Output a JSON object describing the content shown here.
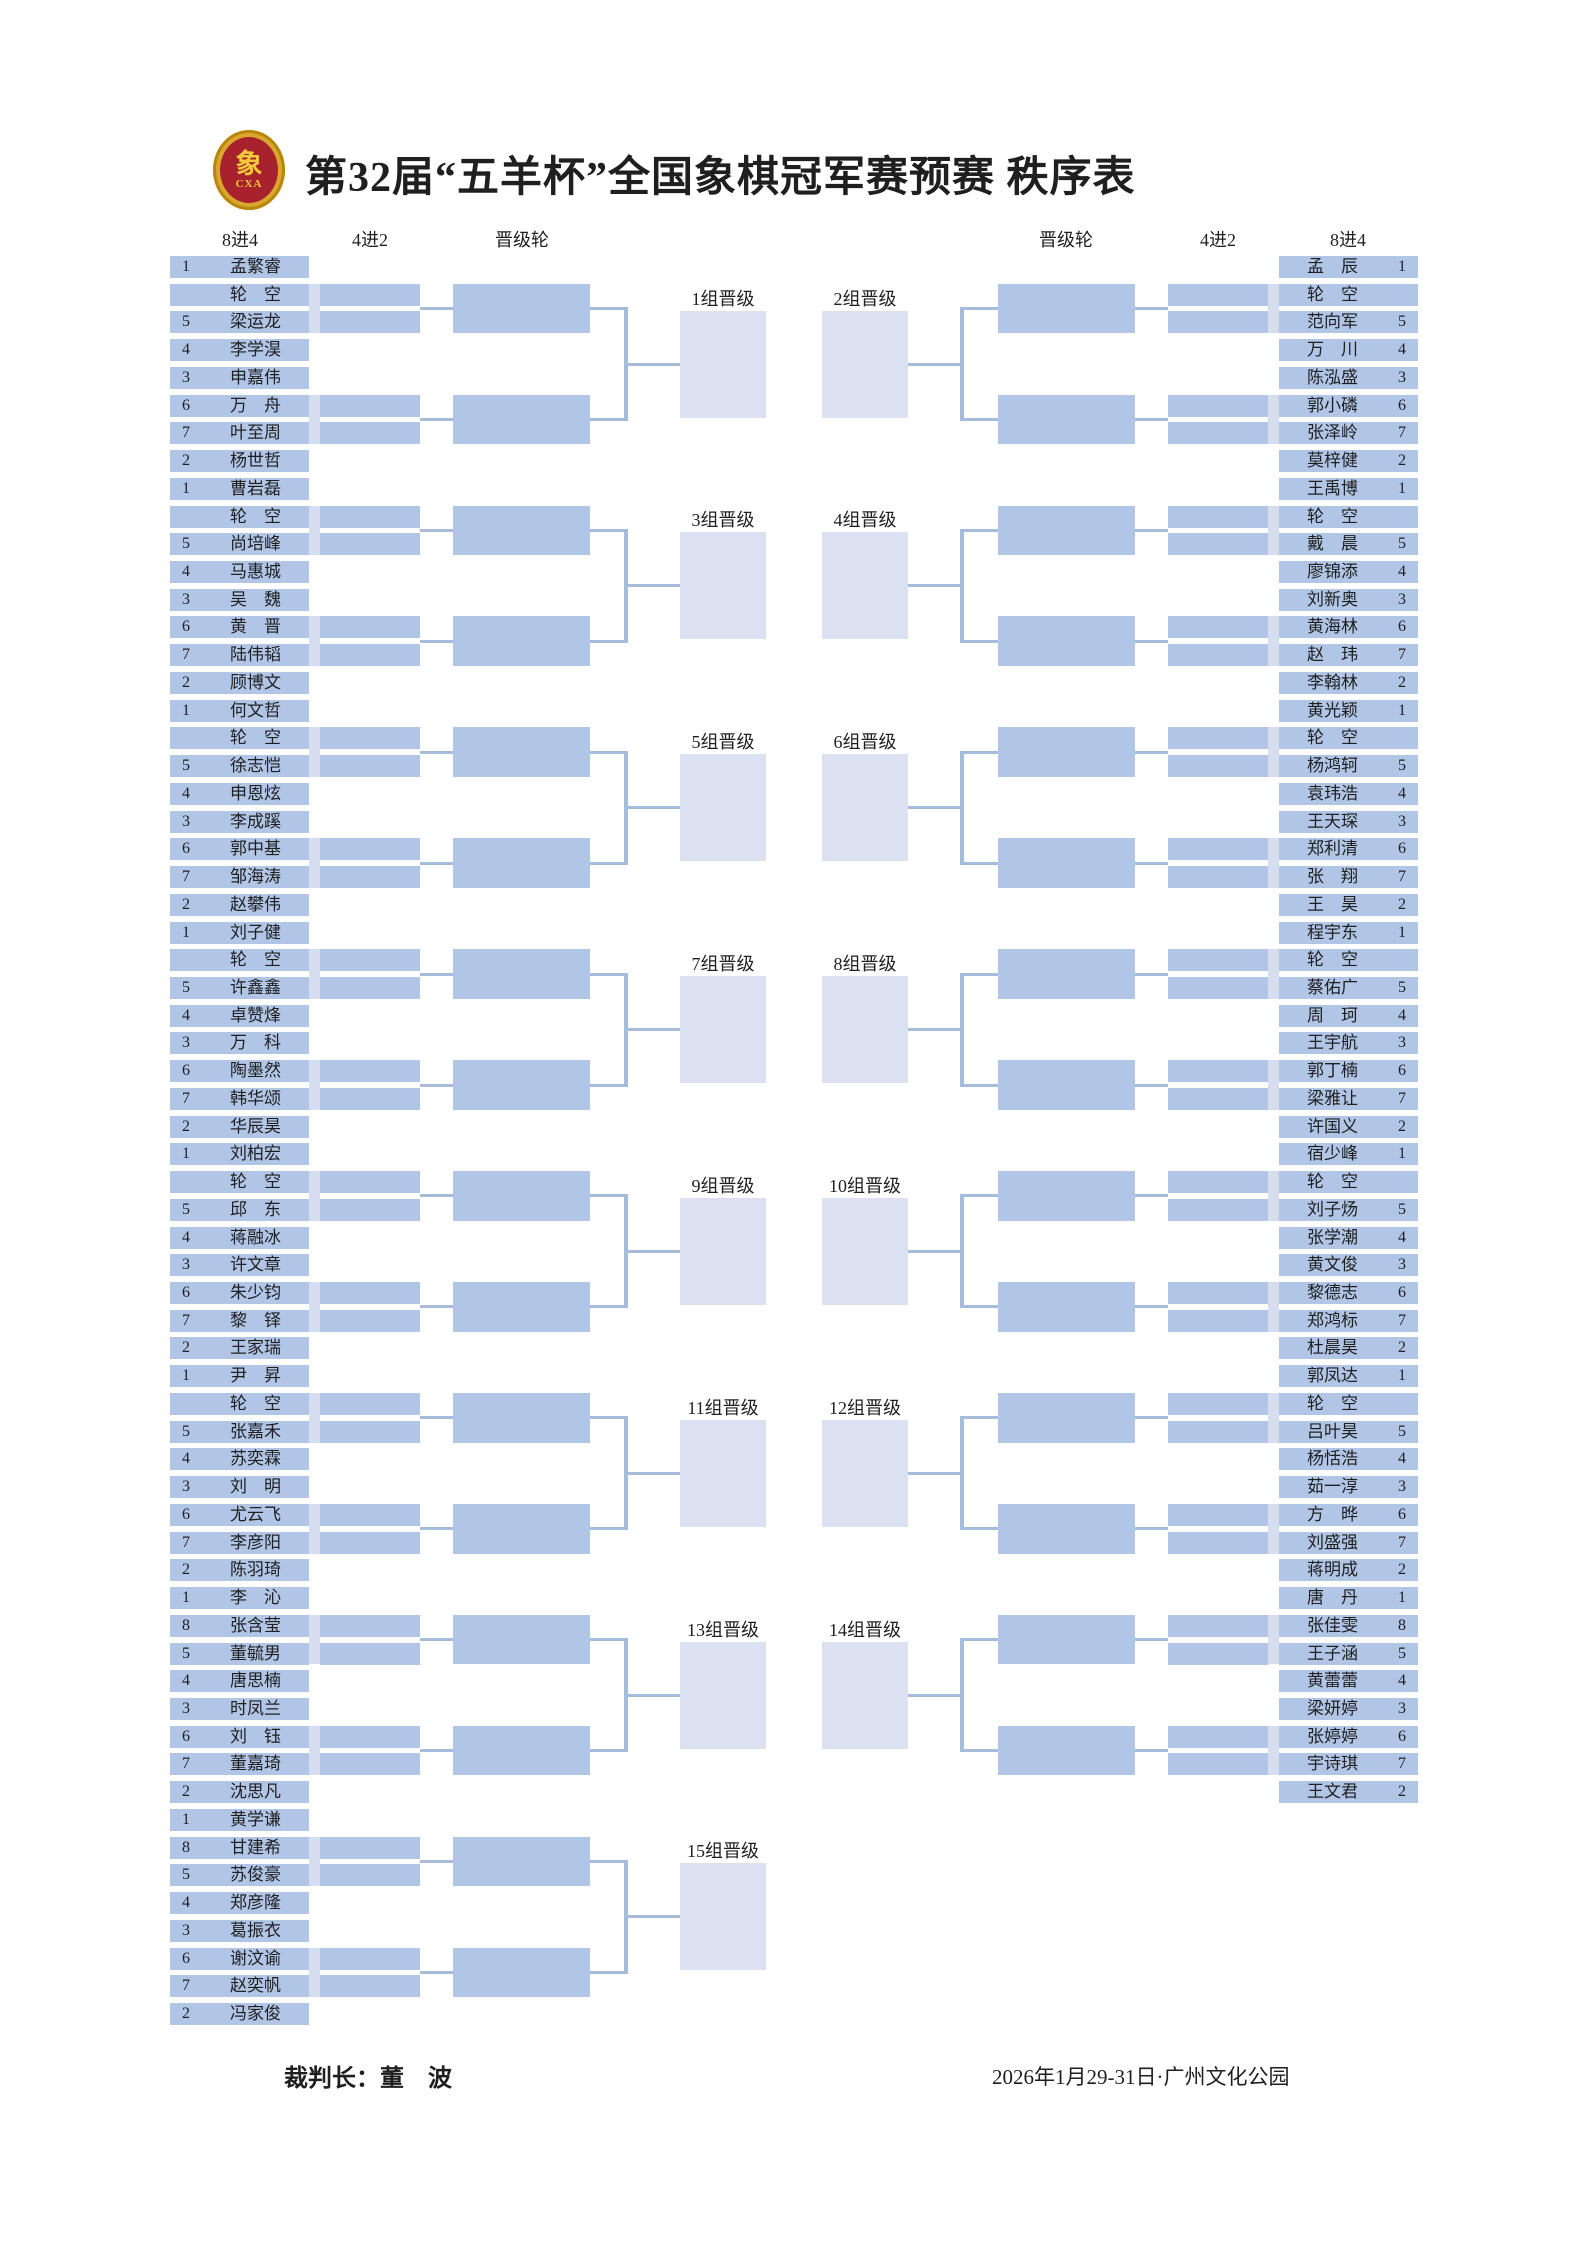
{
  "title": "第32届“五羊杯”全国象棋冠军赛预赛  秩序表",
  "logo": {
    "glyph": "象",
    "sub": "CXA"
  },
  "headers": {
    "left": [
      "8进4",
      "4进2",
      "晋级轮"
    ],
    "right": [
      "晋级轮",
      "4进2",
      "8进4"
    ]
  },
  "footer": {
    "referee": "裁判长：董　波",
    "event_info": "2026年1月29-31日·广州文化公园"
  },
  "colors": {
    "cell": "#b1c5e6",
    "stub": "#d5ddef",
    "box": "#dbe1f1",
    "line": "#a6bcdc",
    "text": "#1f1f1f",
    "logo_gold": "#d9a62e",
    "logo_red": "#a7222c"
  },
  "left_groups": [
    {
      "label": "1组晋级",
      "players": [
        {
          "seed": "1",
          "name": "孟繁睿"
        },
        {
          "seed": "",
          "name": "轮空"
        },
        {
          "seed": "5",
          "name": "梁运龙"
        },
        {
          "seed": "4",
          "name": "李学淏"
        },
        {
          "seed": "3",
          "name": "申嘉伟"
        },
        {
          "seed": "6",
          "name": "万舟"
        },
        {
          "seed": "7",
          "name": "叶至周"
        },
        {
          "seed": "2",
          "name": "杨世哲"
        }
      ]
    },
    {
      "label": "3组晋级",
      "players": [
        {
          "seed": "1",
          "name": "曹岩磊"
        },
        {
          "seed": "",
          "name": "轮空"
        },
        {
          "seed": "5",
          "name": "尚培峰"
        },
        {
          "seed": "4",
          "name": "马惠城"
        },
        {
          "seed": "3",
          "name": "吴魏"
        },
        {
          "seed": "6",
          "name": "黄晋"
        },
        {
          "seed": "7",
          "name": "陆伟韬"
        },
        {
          "seed": "2",
          "name": "顾博文"
        }
      ]
    },
    {
      "label": "5组晋级",
      "players": [
        {
          "seed": "1",
          "name": "何文哲"
        },
        {
          "seed": "",
          "name": "轮空"
        },
        {
          "seed": "5",
          "name": "徐志恺"
        },
        {
          "seed": "4",
          "name": "申恩炫"
        },
        {
          "seed": "3",
          "name": "李成蹊"
        },
        {
          "seed": "6",
          "name": "郭中基"
        },
        {
          "seed": "7",
          "name": "邹海涛"
        },
        {
          "seed": "2",
          "name": "赵攀伟"
        }
      ]
    },
    {
      "label": "7组晋级",
      "players": [
        {
          "seed": "1",
          "name": "刘子健"
        },
        {
          "seed": "",
          "name": "轮空"
        },
        {
          "seed": "5",
          "name": "许鑫鑫"
        },
        {
          "seed": "4",
          "name": "卓赞烽"
        },
        {
          "seed": "3",
          "name": "万科"
        },
        {
          "seed": "6",
          "name": "陶墨然"
        },
        {
          "seed": "7",
          "name": "韩华颂"
        },
        {
          "seed": "2",
          "name": "华辰昊"
        }
      ]
    },
    {
      "label": "9组晋级",
      "players": [
        {
          "seed": "1",
          "name": "刘柏宏"
        },
        {
          "seed": "",
          "name": "轮空"
        },
        {
          "seed": "5",
          "name": "邱东"
        },
        {
          "seed": "4",
          "name": "蒋融冰"
        },
        {
          "seed": "3",
          "name": "许文章"
        },
        {
          "seed": "6",
          "name": "朱少钧"
        },
        {
          "seed": "7",
          "name": "黎铎"
        },
        {
          "seed": "2",
          "name": "王家瑞"
        }
      ]
    },
    {
      "label": "11组晋级",
      "players": [
        {
          "seed": "1",
          "name": "尹昇"
        },
        {
          "seed": "",
          "name": "轮空"
        },
        {
          "seed": "5",
          "name": "张嘉禾"
        },
        {
          "seed": "4",
          "name": "苏奕霖"
        },
        {
          "seed": "3",
          "name": "刘明"
        },
        {
          "seed": "6",
          "name": "尤云飞"
        },
        {
          "seed": "7",
          "name": "李彦阳"
        },
        {
          "seed": "2",
          "name": "陈羽琦"
        }
      ]
    },
    {
      "label": "13组晋级",
      "players": [
        {
          "seed": "1",
          "name": "李沁"
        },
        {
          "seed": "8",
          "name": "张含莹"
        },
        {
          "seed": "5",
          "name": "董毓男"
        },
        {
          "seed": "4",
          "name": "唐思楠"
        },
        {
          "seed": "3",
          "name": "时凤兰"
        },
        {
          "seed": "6",
          "name": "刘钰"
        },
        {
          "seed": "7",
          "name": "董嘉琦"
        },
        {
          "seed": "2",
          "name": "沈思凡"
        }
      ]
    },
    {
      "label": "15组晋级",
      "players": [
        {
          "seed": "1",
          "name": "黄学谦"
        },
        {
          "seed": "8",
          "name": "甘建希"
        },
        {
          "seed": "5",
          "name": "苏俊豪"
        },
        {
          "seed": "4",
          "name": "郑彦隆"
        },
        {
          "seed": "3",
          "name": "葛振衣"
        },
        {
          "seed": "6",
          "name": "谢汶谕"
        },
        {
          "seed": "7",
          "name": "赵奕帆"
        },
        {
          "seed": "2",
          "name": "冯家俊"
        }
      ]
    }
  ],
  "right_groups": [
    {
      "label": "2组晋级",
      "players": [
        {
          "seed": "1",
          "name": "孟辰"
        },
        {
          "seed": "",
          "name": "轮空"
        },
        {
          "seed": "5",
          "name": "范向军"
        },
        {
          "seed": "4",
          "name": "万川"
        },
        {
          "seed": "3",
          "name": "陈泓盛"
        },
        {
          "seed": "6",
          "name": "郭小磷"
        },
        {
          "seed": "7",
          "name": "张泽岭"
        },
        {
          "seed": "2",
          "name": "莫梓健"
        }
      ]
    },
    {
      "label": "4组晋级",
      "players": [
        {
          "seed": "1",
          "name": "王禹博"
        },
        {
          "seed": "",
          "name": "轮空"
        },
        {
          "seed": "5",
          "name": "戴晨"
        },
        {
          "seed": "4",
          "name": "廖锦添"
        },
        {
          "seed": "3",
          "name": "刘新奥"
        },
        {
          "seed": "6",
          "name": "黄海林"
        },
        {
          "seed": "7",
          "name": "赵玮"
        },
        {
          "seed": "2",
          "name": "李翰林"
        }
      ]
    },
    {
      "label": "6组晋级",
      "players": [
        {
          "seed": "1",
          "name": "黄光颖"
        },
        {
          "seed": "",
          "name": "轮空"
        },
        {
          "seed": "5",
          "name": "杨鸿轲"
        },
        {
          "seed": "4",
          "name": "袁玮浩"
        },
        {
          "seed": "3",
          "name": "王天琛"
        },
        {
          "seed": "6",
          "name": "郑利清"
        },
        {
          "seed": "7",
          "name": "张翔"
        },
        {
          "seed": "2",
          "name": "王昊"
        }
      ]
    },
    {
      "label": "8组晋级",
      "players": [
        {
          "seed": "1",
          "name": "程宇东"
        },
        {
          "seed": "",
          "name": "轮空"
        },
        {
          "seed": "5",
          "name": "蔡佑广"
        },
        {
          "seed": "4",
          "name": "周珂"
        },
        {
          "seed": "3",
          "name": "王宇航"
        },
        {
          "seed": "6",
          "name": "郭丁楠"
        },
        {
          "seed": "7",
          "name": "梁雅让"
        },
        {
          "seed": "2",
          "name": "许国义"
        }
      ]
    },
    {
      "label": "10组晋级",
      "players": [
        {
          "seed": "1",
          "name": "宿少峰"
        },
        {
          "seed": "",
          "name": "轮空"
        },
        {
          "seed": "5",
          "name": "刘子炀"
        },
        {
          "seed": "4",
          "name": "张学潮"
        },
        {
          "seed": "3",
          "name": "黄文俊"
        },
        {
          "seed": "6",
          "name": "黎德志"
        },
        {
          "seed": "7",
          "name": "郑鸿标"
        },
        {
          "seed": "2",
          "name": "杜晨昊"
        }
      ]
    },
    {
      "label": "12组晋级",
      "players": [
        {
          "seed": "1",
          "name": "郭凤达"
        },
        {
          "seed": "",
          "name": "轮空"
        },
        {
          "seed": "5",
          "name": "吕叶昊"
        },
        {
          "seed": "4",
          "name": "杨恬浩"
        },
        {
          "seed": "3",
          "name": "茹一淳"
        },
        {
          "seed": "6",
          "name": "方晔"
        },
        {
          "seed": "7",
          "name": "刘盛强"
        },
        {
          "seed": "2",
          "name": "蒋明成"
        }
      ]
    },
    {
      "label": "14组晋级",
      "players": [
        {
          "seed": "1",
          "name": "唐丹"
        },
        {
          "seed": "8",
          "name": "张佳雯"
        },
        {
          "seed": "5",
          "name": "王子涵"
        },
        {
          "seed": "4",
          "name": "黄蕾蕾"
        },
        {
          "seed": "3",
          "name": "梁妍婷"
        },
        {
          "seed": "6",
          "name": "张婷婷"
        },
        {
          "seed": "7",
          "name": "宇诗琪"
        },
        {
          "seed": "2",
          "name": "王文君"
        }
      ]
    }
  ]
}
